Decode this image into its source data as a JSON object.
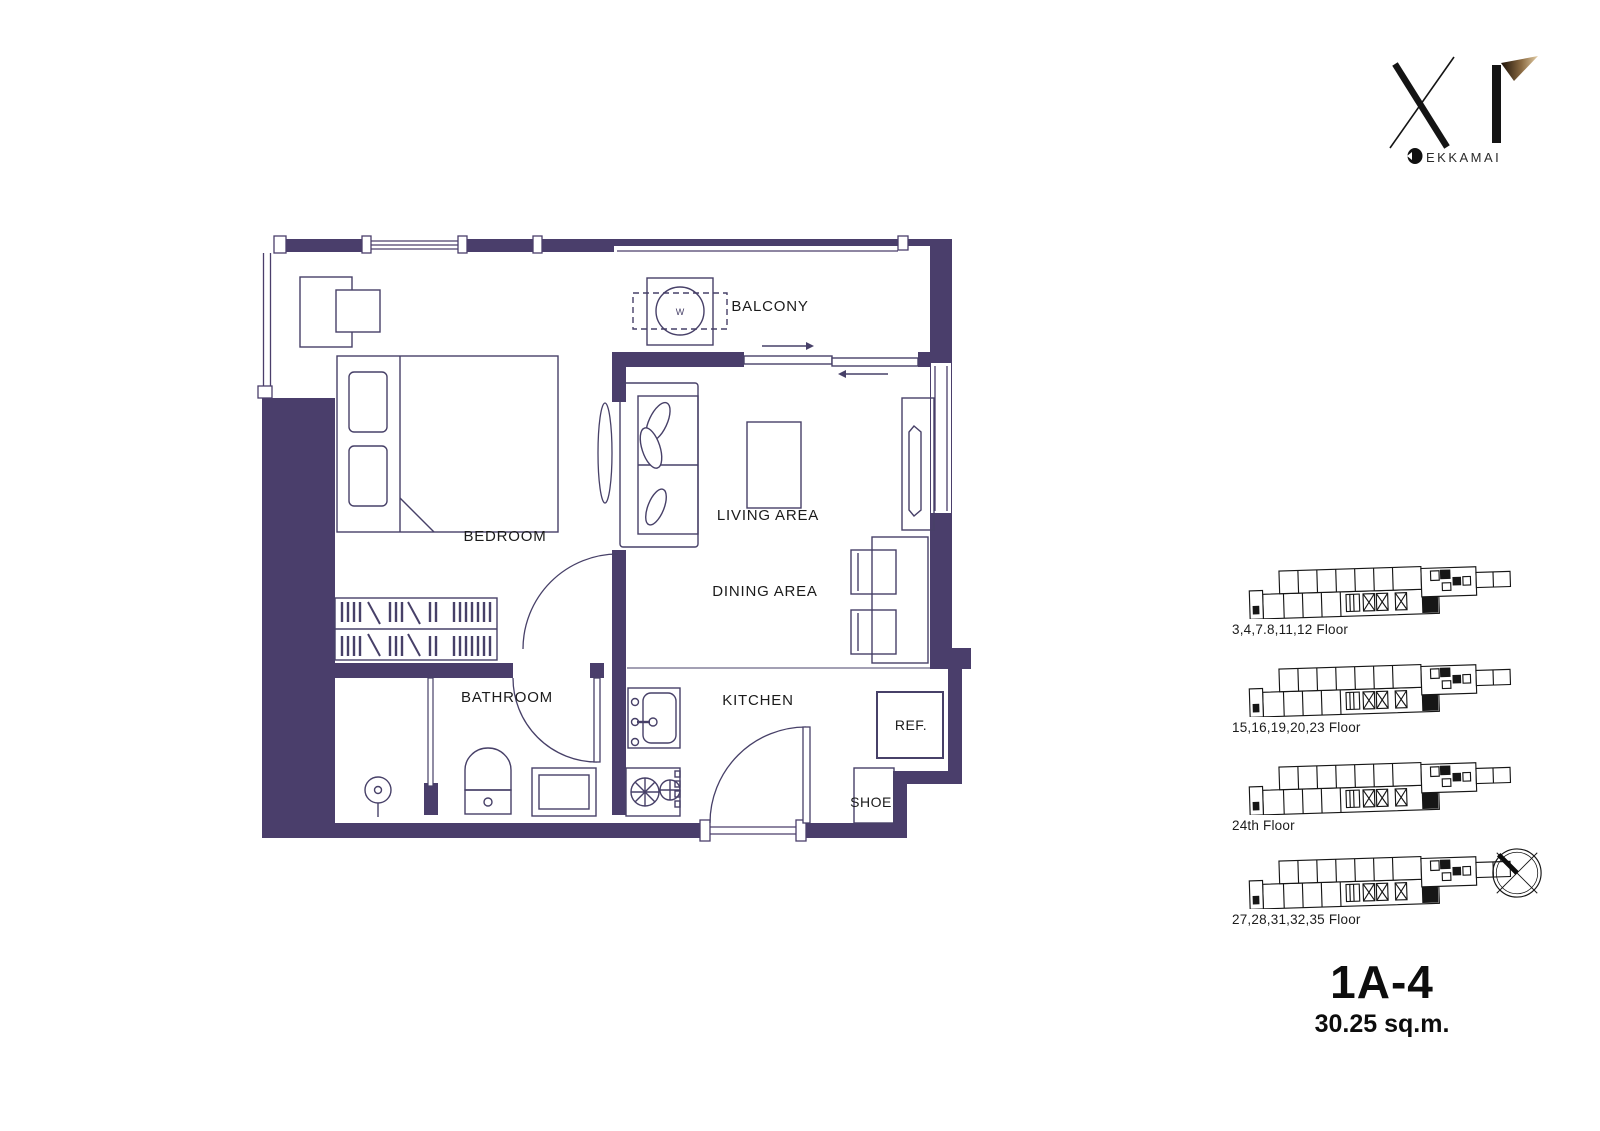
{
  "logo": {
    "brand": "XT",
    "location": "EKKAMAI"
  },
  "floor_plan": {
    "labels": {
      "balcony": "BALCONY",
      "bedroom": "BEDROOM",
      "living_area": "LIVING AREA",
      "dining_area": "DINING AREA",
      "bathroom": "BATHROOM",
      "kitchen": "KITCHEN",
      "refrigerator": "REF.",
      "shoe_cabinet": "SHOE",
      "washer": "W"
    },
    "wall_color": "#4a3e6b",
    "line_color": "#474068"
  },
  "key_plans": [
    {
      "label": "3,4,7.8,11,12 Floor"
    },
    {
      "label": "15,16,19,20,23 Floor"
    },
    {
      "label": "24th Floor"
    },
    {
      "label": "27,28,31,32,35 Floor"
    }
  ],
  "unit": {
    "code": "1A-4",
    "area": "30.25 sq.m."
  }
}
